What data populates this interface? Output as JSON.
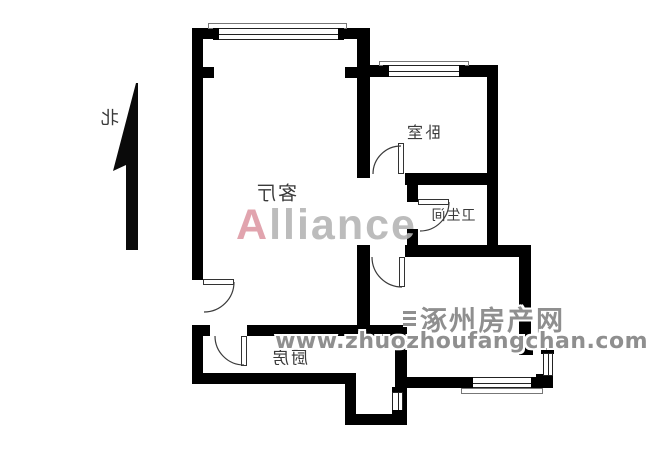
{
  "page": {
    "background": "#ffffff"
  },
  "plan": {
    "wall_color": "#000000",
    "label_color": "#3a3a3a",
    "north_label": "北",
    "rooms": [
      {
        "id": "living-room",
        "label": "客厅"
      },
      {
        "id": "bedroom",
        "label": "卧室"
      },
      {
        "id": "bathroom",
        "label": "卫生间"
      },
      {
        "id": "kitchen",
        "label": "厨房"
      }
    ]
  },
  "watermarks": {
    "alliance": {
      "text": "Alliance",
      "first_letter_color": "#de9ba6",
      "rest_color": "#b5b5b5"
    },
    "site": {
      "name": "涿州房产网",
      "url": "www.zhuozhoufangchan.com",
      "color": "#8f8f8f"
    }
  }
}
